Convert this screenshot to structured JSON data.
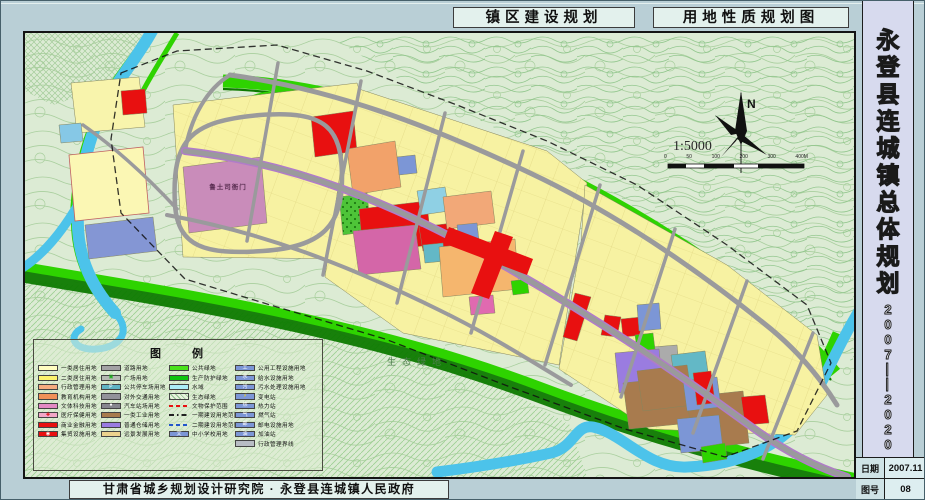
{
  "header": {
    "title1": "镇区建设规划",
    "title2": "用地性质规划图"
  },
  "sidebar": {
    "title_chars": [
      "永",
      "登",
      "县",
      "连",
      "城",
      "镇",
      "总",
      "体",
      "规",
      "划"
    ],
    "years_chars": [
      "2",
      "0",
      "0",
      "7",
      "—",
      "—",
      "2",
      "0",
      "2",
      "0"
    ],
    "info": [
      {
        "label": "日期",
        "value": "2007.11"
      },
      {
        "label": "图号",
        "value": "08"
      }
    ]
  },
  "footer": {
    "credit": "甘肃省城乡规划设计研究院 · 永登县连城镇人民政府"
  },
  "map": {
    "labels": {
      "historic_site": "鲁土司衙门",
      "eco_green": "生态绿地",
      "north": "N",
      "scale_text": "1:5000"
    },
    "scale_ticks": [
      "0",
      "50",
      "100",
      "200",
      "300",
      "400M"
    ]
  },
  "legend": {
    "title": "图 例",
    "columns": [
      [
        {
          "label": "一类居住用地",
          "swatch": {
            "kind": "box",
            "fill": "#fffdc0"
          }
        },
        {
          "label": "二类居住用地",
          "swatch": {
            "kind": "box",
            "fill": "#fbf26e"
          }
        },
        {
          "label": "行政管理用地",
          "swatch": {
            "kind": "box",
            "fill": "#f5ab80"
          }
        },
        {
          "label": "教育机构用地",
          "swatch": {
            "kind": "box",
            "fill": "#f19058"
          }
        },
        {
          "label": "文体科技用地",
          "swatch": {
            "kind": "box",
            "fill": "#e389c4"
          }
        },
        {
          "label": "医疗保健用地",
          "swatch": {
            "kind": "box",
            "fill": "#f2a6c6",
            "glyph": "✚",
            "glyphColor": "#d80000"
          }
        },
        {
          "label": "商业金融用地",
          "swatch": {
            "kind": "box",
            "fill": "#e81010"
          }
        },
        {
          "label": "集贸设施用地",
          "swatch": {
            "kind": "box",
            "fill": "#e81010",
            "glyph": "◉",
            "glyphColor": "#ffffff"
          }
        }
      ],
      [
        {
          "label": "道路用地",
          "swatch": {
            "kind": "box",
            "fill": "#a2a2a4"
          }
        },
        {
          "label": "广场用地",
          "swatch": {
            "kind": "box",
            "fill": "#b4b8b2",
            "glyph": "▣",
            "glyphColor": "#1fae1f"
          }
        },
        {
          "label": "公共停车场用地",
          "swatch": {
            "kind": "box",
            "fill": "#5fb4c4",
            "glyph": "P",
            "glyphColor": "#ffffff"
          }
        },
        {
          "label": "对外交通用地",
          "swatch": {
            "kind": "box",
            "fill": "#92929a"
          }
        },
        {
          "label": "汽车站场用地",
          "swatch": {
            "kind": "box",
            "fill": "#86868e",
            "glyph": "●",
            "glyphColor": "#ffffff"
          }
        },
        {
          "label": "一类工业用地",
          "swatch": {
            "kind": "box",
            "fill": "#a87b4e"
          }
        },
        {
          "label": "普通仓储用地",
          "swatch": {
            "kind": "box",
            "fill": "#9a7ce0"
          }
        },
        {
          "label": "远景发展用地",
          "swatch": {
            "kind": "box",
            "fill": "#ecd28e"
          }
        }
      ],
      [
        {
          "label": "公共绿地",
          "swatch": {
            "kind": "box",
            "fill": "#49e21c"
          }
        },
        {
          "label": "生产防护绿地",
          "swatch": {
            "kind": "box",
            "fill": "#0fc30f"
          }
        },
        {
          "label": "水域",
          "swatch": {
            "kind": "box",
            "fill": "#aceef8"
          }
        },
        {
          "label": "生态绿地",
          "swatch": {
            "kind": "hatch",
            "fill": "#e8f2de",
            "lineColor": "#8cc08c"
          }
        },
        {
          "label": "文物保护范围",
          "swatch": {
            "kind": "line",
            "style": "dashed",
            "color": "#e81010"
          }
        },
        {
          "label": "一期建设用地范围",
          "swatch": {
            "kind": "line",
            "style": "dashdot",
            "color": "#222222"
          }
        },
        {
          "label": "二期建设用地范围",
          "swatch": {
            "kind": "line",
            "style": "dashed",
            "color": "#2255cc"
          }
        },
        {
          "label": "中小学校用地",
          "swatch": {
            "kind": "box",
            "fill": "#7c96d6",
            "glyph": "文",
            "glyphColor": "#ffffff"
          }
        }
      ],
      [
        {
          "label": "公用工程设施用地",
          "swatch": {
            "kind": "box",
            "fill": "#7c96d6",
            "glyph": "工",
            "glyphColor": "#ffffff"
          }
        },
        {
          "label": "给水设施用地",
          "swatch": {
            "kind": "box",
            "fill": "#7c96d6",
            "glyph": "水",
            "glyphColor": "#ffffff"
          }
        },
        {
          "label": "污水处理设施用地",
          "swatch": {
            "kind": "box",
            "fill": "#7c96d6",
            "glyph": "污",
            "glyphColor": "#ffffff"
          }
        },
        {
          "label": "变电站",
          "swatch": {
            "kind": "box",
            "fill": "#7c96d6",
            "glyph": "⚡",
            "glyphColor": "#ffdd00"
          }
        },
        {
          "label": "热力站",
          "swatch": {
            "kind": "box",
            "fill": "#7c96d6",
            "glyph": "热",
            "glyphColor": "#ffffff"
          }
        },
        {
          "label": "燃气站",
          "swatch": {
            "kind": "box",
            "fill": "#7c96d6",
            "glyph": "气",
            "glyphColor": "#ffffff"
          }
        },
        {
          "label": "邮电设施用地",
          "swatch": {
            "kind": "box",
            "fill": "#7c96d6",
            "glyph": "邮",
            "glyphColor": "#ffffff"
          }
        },
        {
          "label": "加油站",
          "swatch": {
            "kind": "box",
            "fill": "#7c96d6",
            "glyph": "油",
            "glyphColor": "#ffffff"
          }
        },
        {
          "label": "行政管理界线",
          "swatch": {
            "kind": "box",
            "fill": "#b8bcc4"
          }
        }
      ]
    ]
  }
}
